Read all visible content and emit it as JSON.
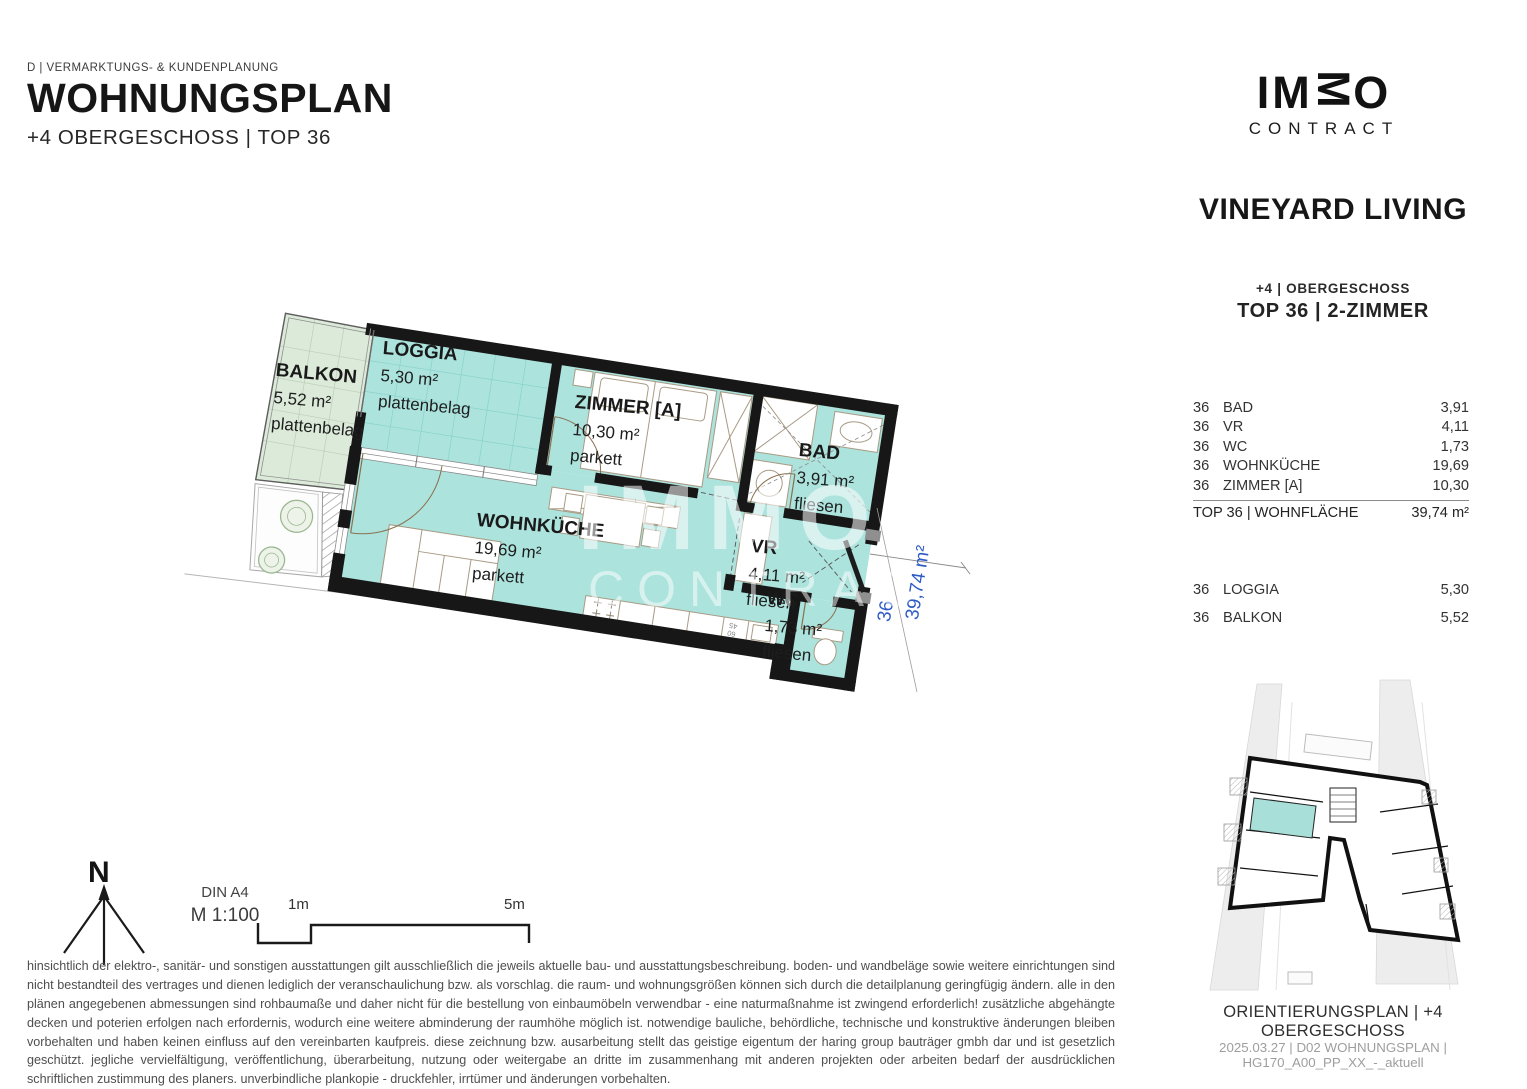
{
  "header": {
    "category": "D | VERMARKTUNGS- & KUNDENPLANUNG",
    "title": "WOHNUNGSPLAN",
    "subtitle": "+4 OBERGESCHOSS | TOP 36"
  },
  "brand": {
    "logo_part1": "IM",
    "logo_part2": "M",
    "logo_part3": "O",
    "logo_sub": "CONTRACT",
    "project": "VINEYARD LIVING"
  },
  "unit": {
    "floor": "+4 | OBERGESCHOSS",
    "top": "TOP 36 | 2-ZIMMER"
  },
  "area_table": {
    "rows": [
      {
        "no": "36",
        "room": "BAD",
        "value": "3,91"
      },
      {
        "no": "36",
        "room": "VR",
        "value": "4,11"
      },
      {
        "no": "36",
        "room": "WC",
        "value": "1,73"
      },
      {
        "no": "36",
        "room": "WOHNKÜCHE",
        "value": "19,69"
      },
      {
        "no": "36",
        "room": "ZIMMER [A]",
        "value": "10,30"
      }
    ],
    "total_label": "TOP 36 | WOHNFLÄCHE",
    "total_value": "39,74 m²",
    "outdoor": [
      {
        "no": "36",
        "room": "LOGGIA",
        "value": "5,30"
      },
      {
        "no": "36",
        "room": "BALKON",
        "value": "5,52"
      }
    ]
  },
  "floorplan": {
    "balkon": {
      "name": "BALKON",
      "area": "5,52 m²",
      "floor": "plattenbelag"
    },
    "loggia": {
      "name": "LOGGIA",
      "area": "5,30 m²",
      "floor": "plattenbelag"
    },
    "zimmer": {
      "name": "ZIMMER [A]",
      "area": "10,30 m²",
      "floor": "parkett"
    },
    "wohnkueche": {
      "name": "WOHNKÜCHE",
      "area": "19,69 m²",
      "floor": "parkett"
    },
    "bad": {
      "name": "BAD",
      "area": "3,91 m²",
      "floor": "fliesen"
    },
    "vr": {
      "name": "VR",
      "area": "4,11 m²",
      "floor": "fliesen"
    },
    "wc": {
      "name": "WC",
      "area": "1,73 m²",
      "floor": "fliesen"
    },
    "dim_unit": "36",
    "dim_area": "39,74 m²",
    "kitchen_note_top": "60",
    "kitchen_note_bottom": "45",
    "watermark_line1": "IMMO",
    "watermark_line2": "CONTRACT"
  },
  "legend": {
    "north": "N",
    "paper": "DIN A4",
    "scale": "M 1:100",
    "tick_1m": "1m",
    "tick_5m": "5m"
  },
  "disclaimer": "hinsichtlich der elektro-, sanitär- und sonstigen ausstattungen gilt ausschließlich die jeweils aktuelle bau- und ausstattungsbeschreibung. boden- und wandbeläge sowie weitere einrichtungen sind nicht bestandteil des vertrages und dienen lediglich der veranschaulichung bzw. als vorschlag. die raum- und wohnungsgrößen können sich durch die detailplanung geringfügig ändern. alle in den plänen angegebenen abmessungen sind rohbaumaße und daher nicht für die bestellung von einbaumöbeln verwendbar - eine naturmaßnahme ist zwingend erforderlich! zusätzliche abgehängte decken und poterien erfolgen nach erfordernis, wodurch eine weitere abminderung der raumhöhe möglich ist. notwendige bauliche, behördliche, technische und konstruktive änderungen bleiben vorbehalten und haben keinen einfluss auf den vereinbarten kaufpreis. diese zeichnung bzw. ausarbeitung stellt das geistige eigentum der haring group bauträger gmbh dar und ist gesetzlich geschützt. jegliche vervielfältigung, veröffentlichung, überarbeitung, nutzung oder weitergabe an dritte im zusammenhang mit anderen projekten oder arbeiten bedarf der ausdrücklichen schriftlichen zustimmung des planers. unverbindliche plankopie - druckfehler, irrtümer und änderungen vorbehalten.",
  "orientation": {
    "caption": "ORIENTIERUNGSPLAN | +4 OBERGESCHOSS",
    "footer": "2025.03.27 | D02 WOHNUNGSPLAN | HG170_A00_PP_XX_-_aktuell"
  },
  "colors": {
    "interior": "#ace3dd",
    "balcony": "#dcead9",
    "wall": "#181818",
    "dimension_blue": "#2e5bc6"
  }
}
